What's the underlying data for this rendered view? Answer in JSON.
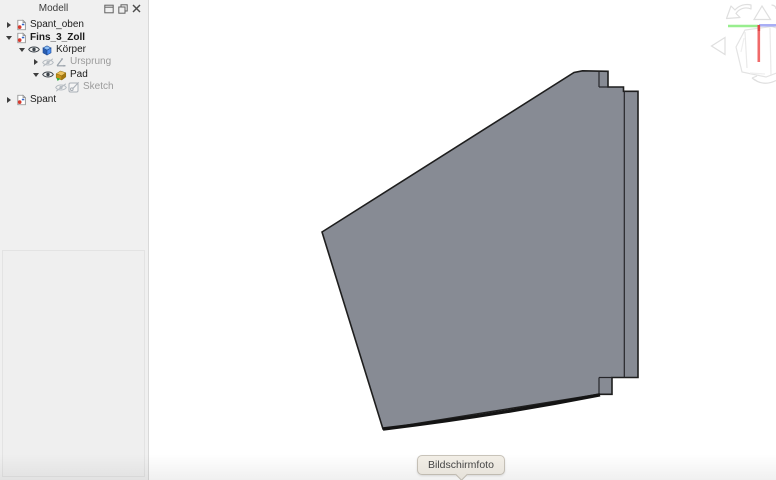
{
  "panel": {
    "title": "Modell",
    "controls": [
      {
        "name": "dock-window-icon"
      },
      {
        "name": "float-window-icon"
      },
      {
        "name": "close-icon"
      }
    ],
    "tree": [
      {
        "label": "Spant_oben",
        "level": 0,
        "expander": "collapsed",
        "style": "normal",
        "type_icon": "document-icon"
      },
      {
        "label": "Fins_3_Zoll",
        "level": 0,
        "expander": "expanded",
        "style": "bold",
        "type_icon": "document-icon"
      },
      {
        "label": "Körper",
        "level": 1,
        "expander": "expanded",
        "style": "normal",
        "visibility": "visible",
        "type_icon": "body-icon"
      },
      {
        "label": "Ursprung",
        "level": 2,
        "expander": "collapsed",
        "style": "disabled",
        "visibility": "hidden",
        "type_icon": "origin-icon"
      },
      {
        "label": "Pad",
        "level": 2,
        "expander": "expanded",
        "style": "normal",
        "visibility": "visible",
        "type_icon": "pad-icon"
      },
      {
        "label": "Sketch",
        "level": 3,
        "expander": "none",
        "style": "disabled",
        "visibility": "hidden",
        "type_icon": "sketch-icon"
      },
      {
        "label": "Spant",
        "level": 0,
        "expander": "collapsed",
        "style": "normal",
        "type_icon": "document-icon"
      }
    ]
  },
  "viewport": {
    "tooltip": "Bildschirmfoto",
    "nav_icons": [
      "rotate-ccw-arrow-icon",
      "triangle-up-icon",
      "triangle-left-icon",
      "rotate-cw-arrow-icon",
      "nav-cube-icon"
    ]
  },
  "colors": {
    "plate_fill": "#878b94",
    "plate_stroke": "#1e1e1e",
    "panel_bg": "#f0f0f0",
    "axis_green": "#98ee8e",
    "axis_red": "#f06a6a",
    "axis_red_dark": "#e04848",
    "axis_blue": "#a9aef5",
    "nav_gray": "#dfdfdf",
    "tooltip_bg": "#f3efe7"
  }
}
